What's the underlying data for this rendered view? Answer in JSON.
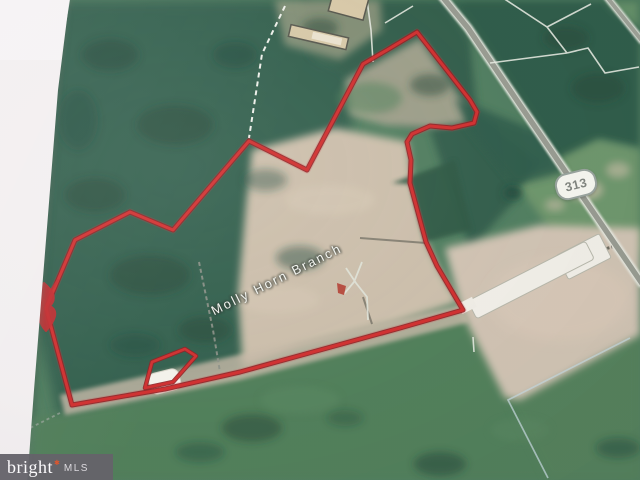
{
  "map": {
    "stream_label": "Molly Horn Branch",
    "route_shield": "313",
    "colors": {
      "boundary_red": "#c42127",
      "forest_green": "#2e5c49",
      "field_green": "#4e7c56",
      "plowed_tan": "#cbbda9",
      "road_gray": "#95988e",
      "parcel_line_white": "#e8ebe2",
      "photo_edge_white": "#f3eff0"
    }
  },
  "watermark": {
    "brand": "bright",
    "mark": "✱",
    "suffix": "MLS",
    "bg_color": "#65636a",
    "mark_color": "#e0562c"
  }
}
